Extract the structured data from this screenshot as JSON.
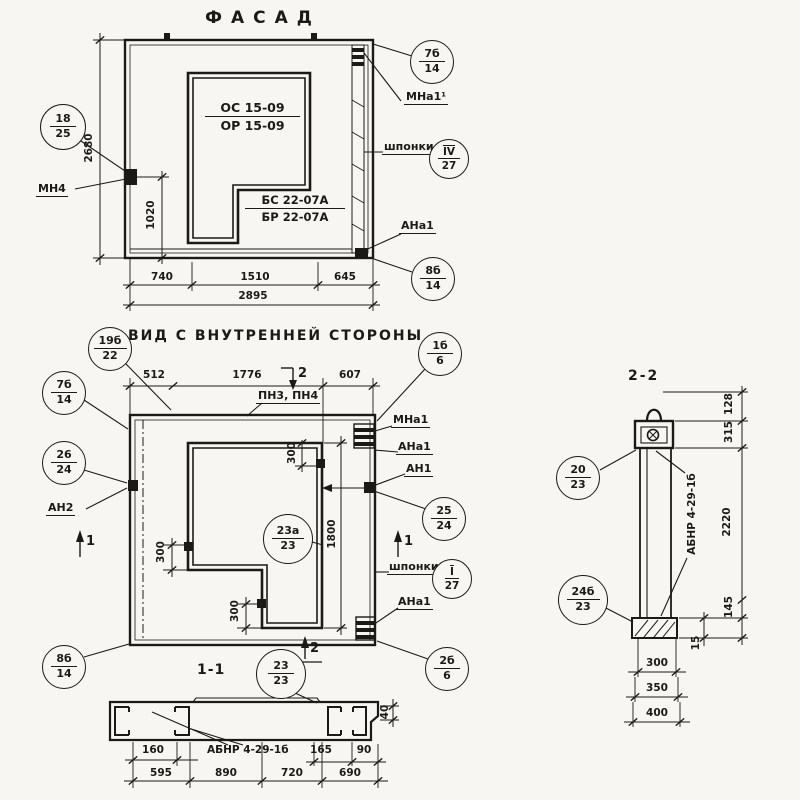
{
  "titles": {
    "facade": "ФАСАД",
    "inner_view": "ВИД С ВНУТРЕННЕЙ СТОРОНЫ",
    "section_11": "1-1",
    "section_22": "2-2"
  },
  "facade": {
    "marks": {
      "os": "ОС 15-09",
      "or": "ОР 15-09",
      "bs": "БС 22-07А",
      "br": "БР 22-07А"
    },
    "labels": {
      "mn4": "МН4",
      "mna1_sup": "МНа1¹",
      "shponki": "шпонки",
      "ana1": "АНа1"
    },
    "callouts": {
      "left": {
        "top": "18",
        "bottom": "25"
      },
      "top_right": {
        "top": "7б",
        "bottom": "14"
      },
      "keys": {
        "top": "IV",
        "bottom": "27"
      },
      "bottom_right": {
        "top": "8б",
        "bottom": "14"
      }
    },
    "dims": {
      "height": "2680",
      "anchor_h": "1020",
      "w1": "740",
      "w2": "1510",
      "w3": "645",
      "total": "2895"
    }
  },
  "inner": {
    "labels": {
      "pn": "ПН3, ПН4",
      "mna1": "МНа1",
      "ana1_top": "АНа1",
      "an1": "АН1",
      "an2": "АН2",
      "shponki": "шпонки",
      "ana1_bottom": "АНа1"
    },
    "callouts": {
      "top_left": {
        "top": "19б",
        "bottom": "22"
      },
      "top_right": {
        "top": "1б",
        "bottom": "6"
      },
      "left_upper": {
        "top": "7б",
        "bottom": "14"
      },
      "left_mid": {
        "top": "26",
        "bottom": "24"
      },
      "right_mid": {
        "top": "25",
        "bottom": "24"
      },
      "center": {
        "top": "23а",
        "bottom": "23"
      },
      "keys": {
        "top": "I",
        "bottom": "27"
      },
      "bottom_left": {
        "top": "8б",
        "bottom": "14"
      },
      "bottom_right": {
        "top": "2б",
        "bottom": "6"
      }
    },
    "dims": {
      "w1": "512",
      "w2": "1776",
      "w3": "607",
      "opening_h": "1800",
      "a1": "300",
      "a2": "300",
      "a3": "300"
    },
    "section_marks": {
      "s1": "1",
      "s2": "2"
    }
  },
  "section11": {
    "label": "АБНР 4-29-1б",
    "callout": {
      "top": "23",
      "bottom": "23"
    },
    "dims": {
      "d160": "160",
      "d165": "165",
      "d90": "90",
      "d40": "40",
      "w1": "595",
      "w2": "890",
      "w3": "720",
      "w4": "690"
    }
  },
  "section22": {
    "label": "АБНР 4-29-1б",
    "callouts": {
      "upper": {
        "top": "20",
        "bottom": "23"
      },
      "lower": {
        "top": "24б",
        "bottom": "23"
      }
    },
    "dims": {
      "d128": "128",
      "d315": "315",
      "d2220": "2220",
      "d145": "145",
      "d15": "15",
      "b1": "300",
      "b2": "350",
      "b3": "400"
    }
  }
}
